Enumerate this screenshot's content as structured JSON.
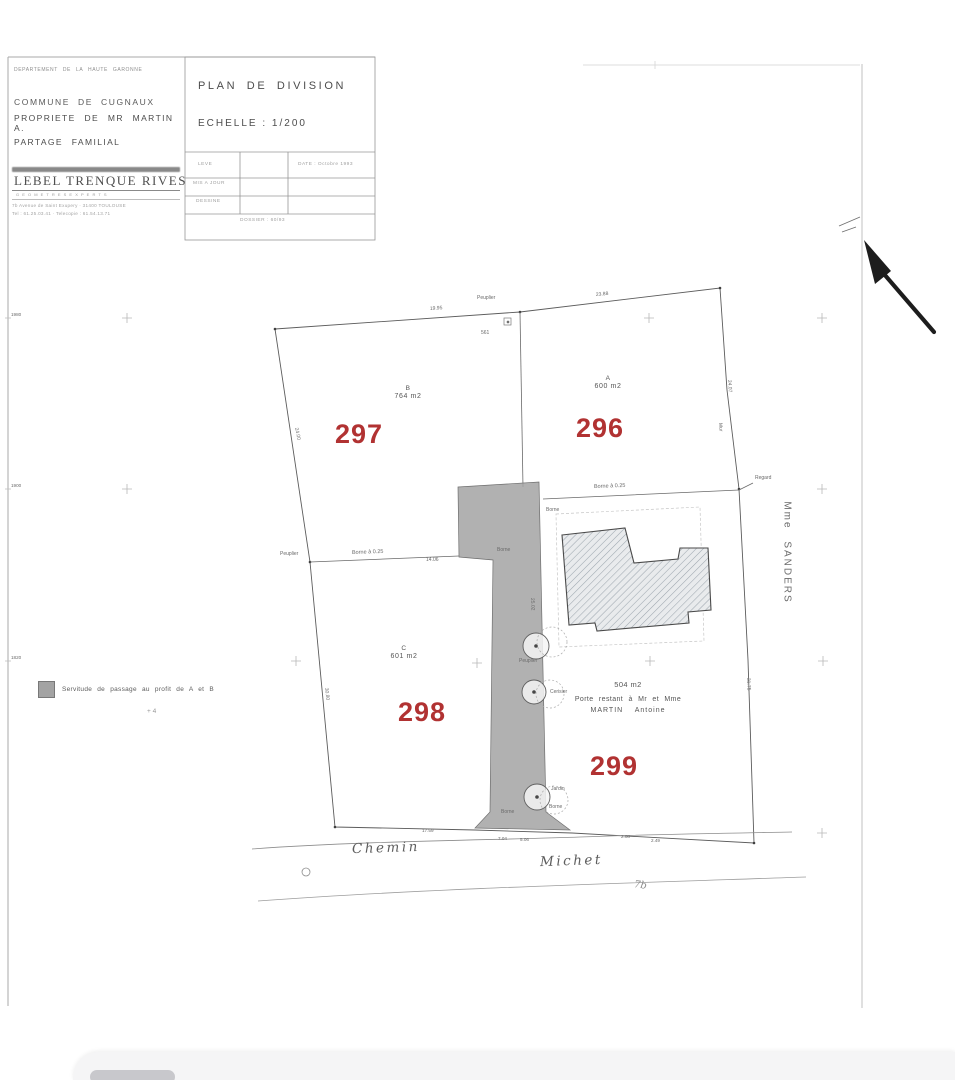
{
  "header": {
    "department": "DEPARTEMENT DE LA HAUTE GARONNE",
    "commune": "COMMUNE DE CUGNAUX",
    "owner": "PROPRIETE DE MR MARTIN A.",
    "subtitle": "PARTAGE FAMILIAL"
  },
  "stamp": {
    "name": "LEBEL TRENQUE RIVES",
    "profession": "G E O M E T R E S   E X P E R T S",
    "address": "7b Avenue de Saint Exupery · 31400 TOULOUSE",
    "phone": "Tel : 61.25.03.41 · Telecopie : 61.54.13.71"
  },
  "title_box": {
    "title": "PLAN DE DIVISION",
    "scale": "ECHELLE : 1/200",
    "row1": "LEVE",
    "row2": "MIS A JOUR",
    "row3": "DESSINE",
    "date": "DATE : Octobre 1993",
    "dossier": "DOSSIER : 60/93"
  },
  "parcels": {
    "p297": {
      "number": "297",
      "letter": "B",
      "area": "764 m2"
    },
    "p296": {
      "number": "296",
      "letter": "A",
      "area": "600 m2"
    },
    "p298": {
      "number": "298",
      "letter": "C",
      "area": "601 m2"
    },
    "p299": {
      "number": "299",
      "area": "504 m2",
      "note1": "Porte restant à Mr et Mme",
      "note2": "MARTIN Antoine"
    }
  },
  "labels": {
    "neighbor": "Mme SANDERS",
    "road_name_1": "Chemin",
    "road_name_2": "Michet",
    "road_mark": "7b",
    "legend": "Servitude de passage au profit de A et B",
    "legend_sub": "+ 4",
    "borne_025_a": "Borne à 0.25",
    "borne_025_b": "Borne à 0.25",
    "peuplier_top": "Peuplier",
    "peuplier_left": "Peuplier",
    "tree_1": "Peuplier",
    "tree_2": "Cerisier",
    "tree_3": "Jardin",
    "borne_1": "Borne",
    "borne_2": "Borne",
    "borne_3": "Borne",
    "borne_4": "Borne",
    "regard": "Regard",
    "mur": "Mur",
    "point_561": "561"
  },
  "dimensions": {
    "top_1": "19.95",
    "top_2": "23.88",
    "left_1": "24.00",
    "left_2": "30.80",
    "right_1": "24.07",
    "right_2": "31.75",
    "strip_1": "25.02",
    "div_left": "14.06",
    "bottom_1": "17.59",
    "bottom_2": "7.04",
    "bottom_3": "5.06",
    "bottom_4": "2.08",
    "bottom_5": "2.49"
  },
  "grid_coords": {
    "c1": "1980",
    "c2": "1900",
    "c3": "1820"
  },
  "colors": {
    "parcel_number_red": "#b13232",
    "servitude_gray": "#a3a3a3",
    "paper": "#ffffff"
  }
}
